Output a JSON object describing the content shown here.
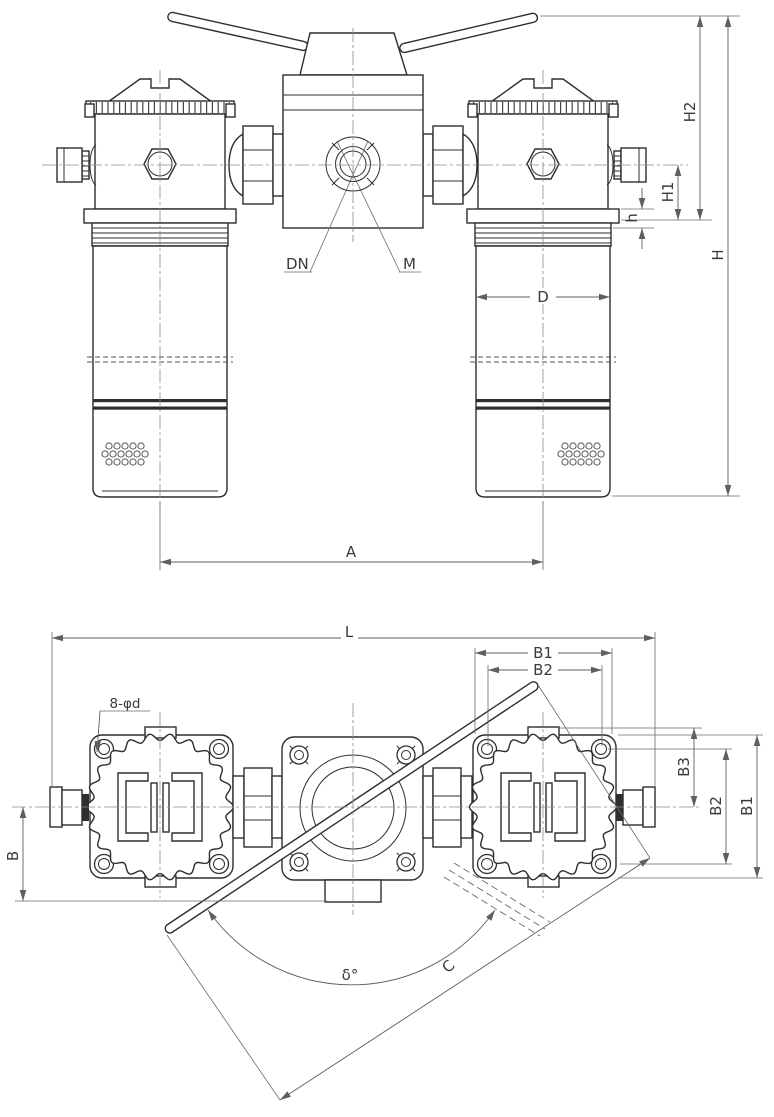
{
  "front_view": {
    "port_labels": {
      "dn": "DN",
      "m": "M"
    },
    "dim_labels": {
      "h2": "H2",
      "h1": "H1",
      "h": "h",
      "height": "H",
      "d": "D",
      "a": "A"
    }
  },
  "plan_view": {
    "dim_labels": {
      "l": "L",
      "b": "B",
      "b1": "B1",
      "b2": "B2",
      "b3": "B3",
      "c": "C",
      "delta": "δ°",
      "holes": "8-φd"
    }
  },
  "colors": {
    "line": "#2e2e2e",
    "dimension": "#5f5f5f",
    "centerline": "#8a8a8a",
    "background": "#ffffff"
  }
}
